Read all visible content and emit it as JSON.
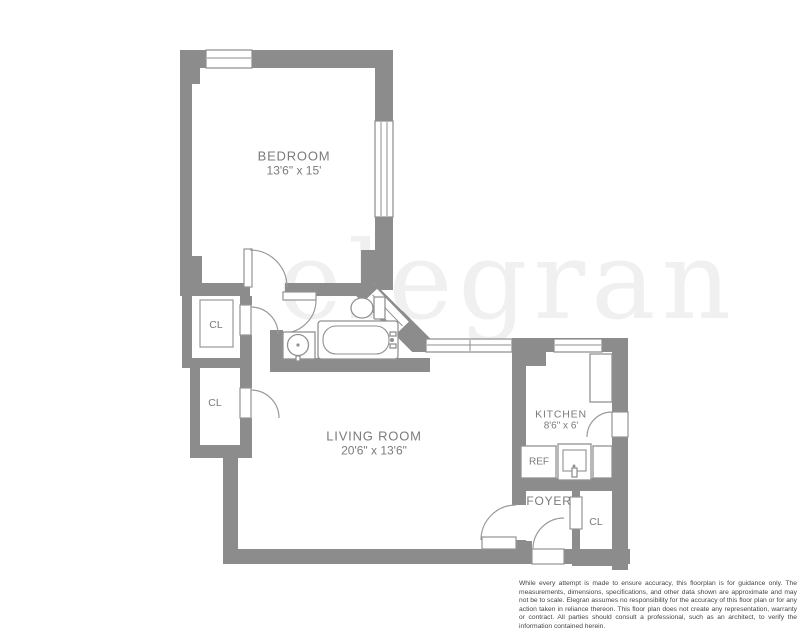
{
  "watermark_text": "elegran",
  "rooms": {
    "bedroom": {
      "label": "BEDROOM",
      "dims": "13'6\" x 15'"
    },
    "living_room": {
      "label": "LIVING ROOM",
      "dims": "20'6\" x 13'6\""
    },
    "kitchen": {
      "label": "KITCHEN",
      "dims": "8'6\" x 6'"
    },
    "foyer": {
      "label": "FOYER"
    },
    "refrigerator": {
      "label": "REF"
    }
  },
  "closets": [
    "CL",
    "CL",
    "CL"
  ],
  "colors": {
    "wall": "#8c8c8c",
    "label_text": "#7b7b7b",
    "watermark": "#f0f0f0",
    "disclaimer_text": "#454545"
  },
  "disclaimer": "While every attempt is made to ensure accuracy, this floorplan is for guidance only. The measurements, dimensions, specifications, and other data shown are approximate and may not be to scale. Elegran assumes no responsibility for the accuracy of this floor plan or for any action taken in reliance thereon. This floor plan does not create any representation, warranty or contract. All parties should consult a professional, such as an architect, to verify the information contained herein."
}
